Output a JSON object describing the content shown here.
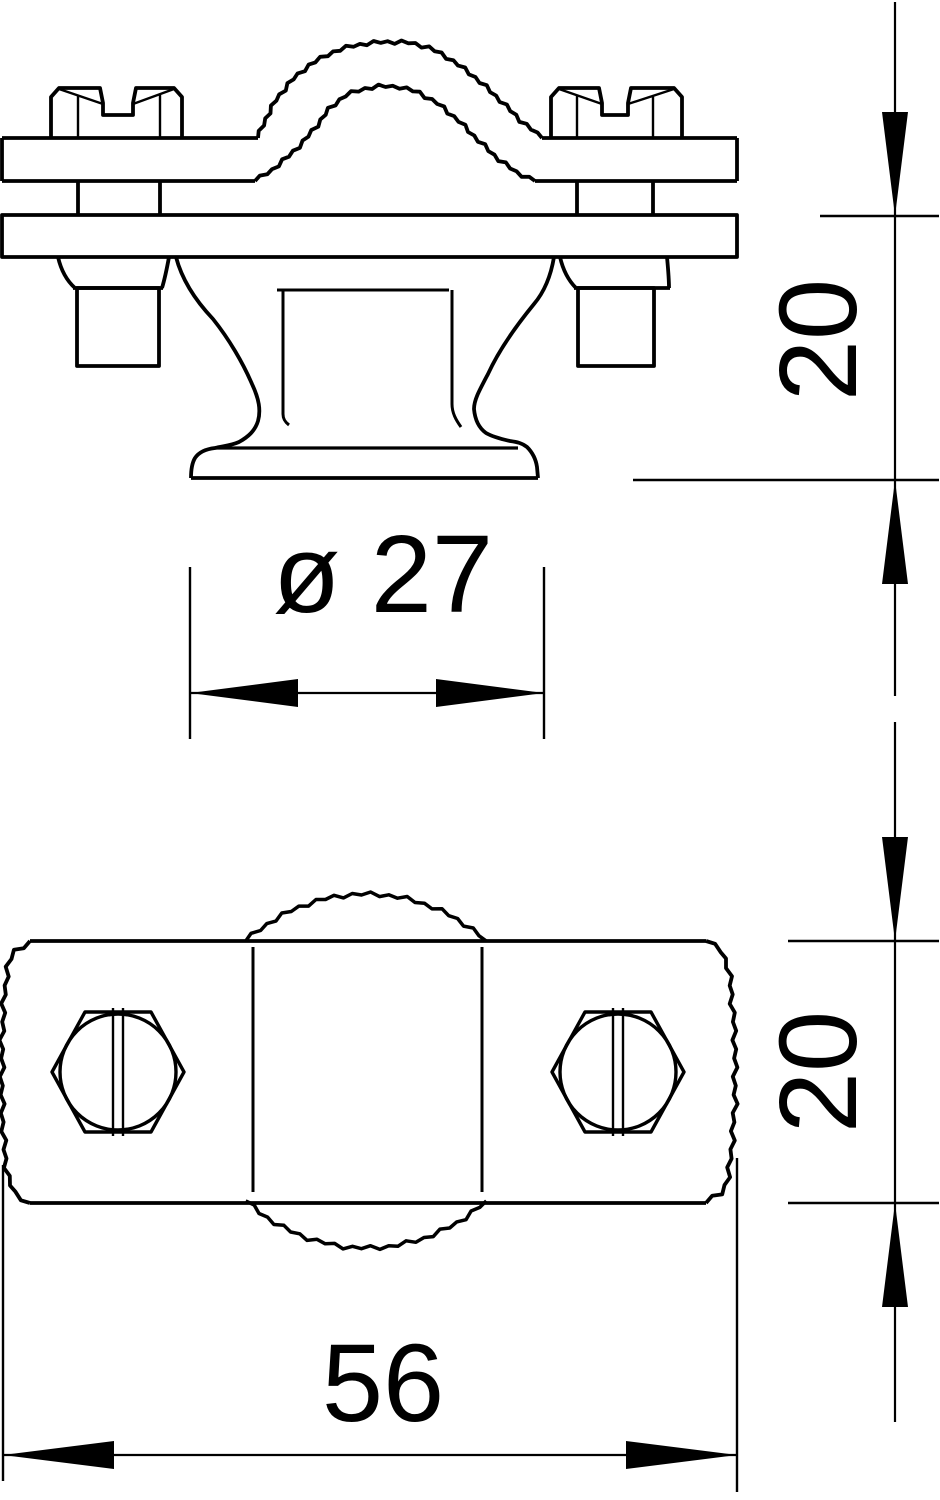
{
  "colors": {
    "background": "#ffffff",
    "line": "#000000"
  },
  "dims": {
    "side_height": {
      "label": "20"
    },
    "foot_diameter": {
      "label": "ø 27"
    },
    "plan_height": {
      "label": "20"
    },
    "plan_width": {
      "label": "56"
    }
  }
}
